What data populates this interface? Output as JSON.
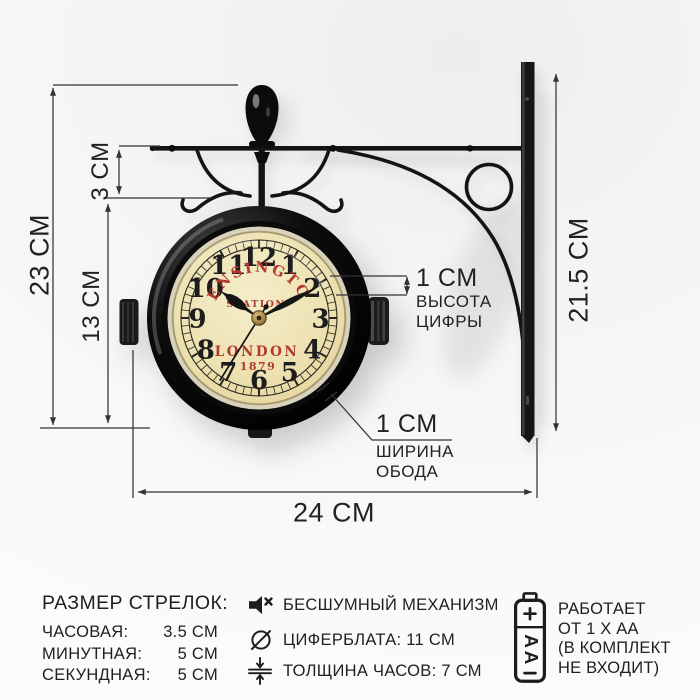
{
  "annotations": {
    "height_total": "23 CM",
    "bracket_drop": "3 CM",
    "clock_height": "13 CM",
    "wall_bar_height": "21.5 CM",
    "width_total": "24 CM",
    "digit": {
      "value": "1 CM",
      "line1": "ВЫСОТА",
      "line2": "ЦИФРЫ"
    },
    "rim": {
      "value": "1 CM",
      "line1": "ШИРИНА",
      "line2": "ОБОДА"
    }
  },
  "clock": {
    "brand": "KENSINGTON",
    "sub": "STATION",
    "city": "LONDON",
    "year": "1879",
    "numerals": [
      "12",
      "1",
      "2",
      "3",
      "4",
      "5",
      "6",
      "7",
      "8",
      "9",
      "10",
      "11"
    ],
    "time": {
      "hour_deg": 305,
      "minute_deg": 62,
      "second_deg": 212
    },
    "colors": {
      "face": "#efe5bb",
      "red": "#b5382e",
      "numeral": "#1d1d1d",
      "rim": "#0a0a0a"
    }
  },
  "specs": {
    "hands": {
      "title": "РАЗМЕР СТРЕЛОК:",
      "rows": [
        {
          "label": "ЧАСОВАЯ:",
          "value": "3.5 СМ"
        },
        {
          "label": "МИНУТНАЯ:",
          "value": "5 СМ"
        },
        {
          "label": "СЕКУНДНАЯ:",
          "value": "5 СМ"
        }
      ]
    },
    "features": [
      {
        "icon": "muted-speaker-icon",
        "text": "БЕСШУМНЫЙ МЕХАНИЗМ"
      },
      {
        "icon": "diameter-icon",
        "text": "ЦИФЕРБЛАТА: 11 СМ"
      },
      {
        "icon": "thickness-icon",
        "text": "ТОЛЩИНА ЧАСОВ: 7 СМ"
      }
    ],
    "power": {
      "lines": [
        "РАБОТАЕТ",
        "ОТ 1 Х АА",
        "(В КОМПЛЕКТ",
        "НЕ ВХОДИТ)"
      ],
      "battery": {
        "plus": "+",
        "label": "AA",
        "minus": "–"
      }
    }
  }
}
